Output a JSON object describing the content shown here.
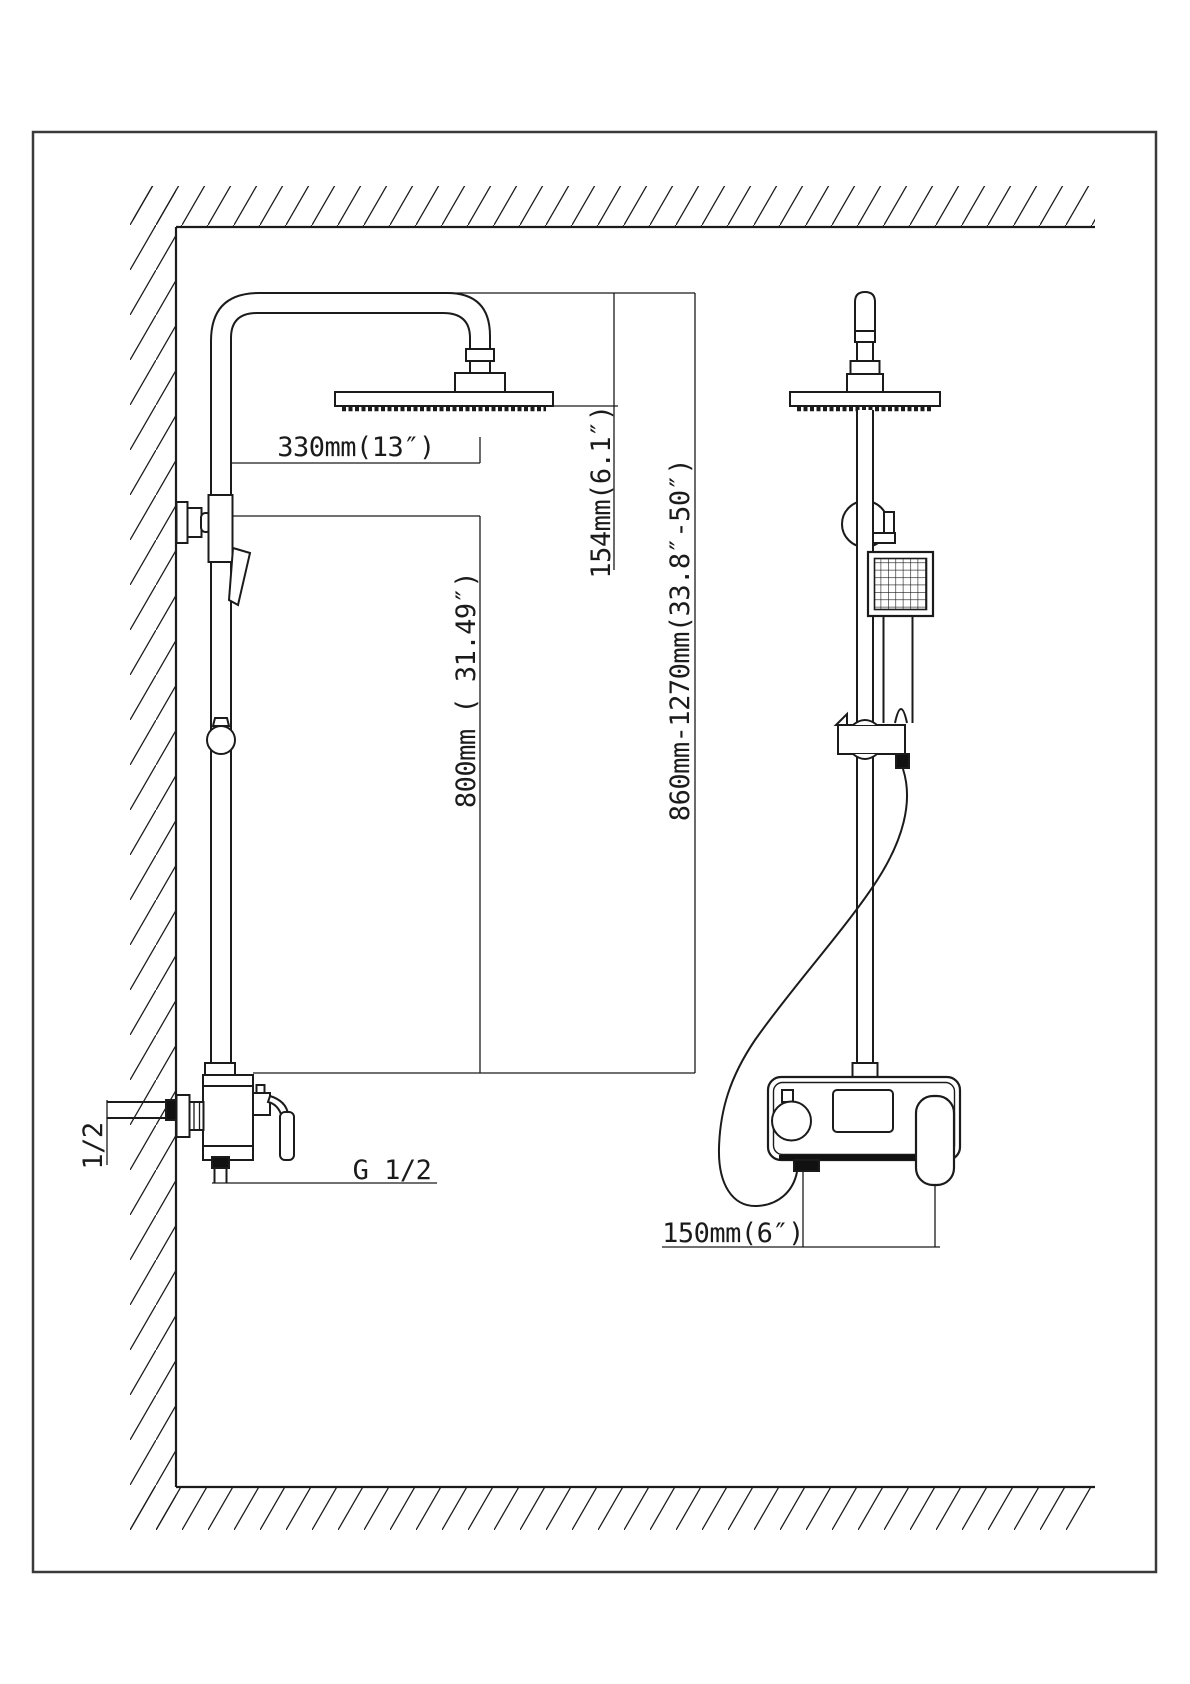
{
  "title": "Shower system installation dimension drawing",
  "views": {
    "side_view": "wall-mounted shower column side view",
    "front_view": "shower column front view"
  },
  "dimensions": {
    "arm_reach": "330mm(13″)",
    "head_height": "154mm(6.1″)",
    "riser_range": "860mm-1270mm(33.8″-50″)",
    "head_to_mixer": "800mm ( 31.49″)",
    "outlet_offset": "150mm(6″)",
    "outlet_thread": "G 1/2",
    "supply_thread": "1/2"
  },
  "colors": {
    "line": "#1b1b1b",
    "border": "#3a3a3a",
    "background": "#ffffff"
  }
}
